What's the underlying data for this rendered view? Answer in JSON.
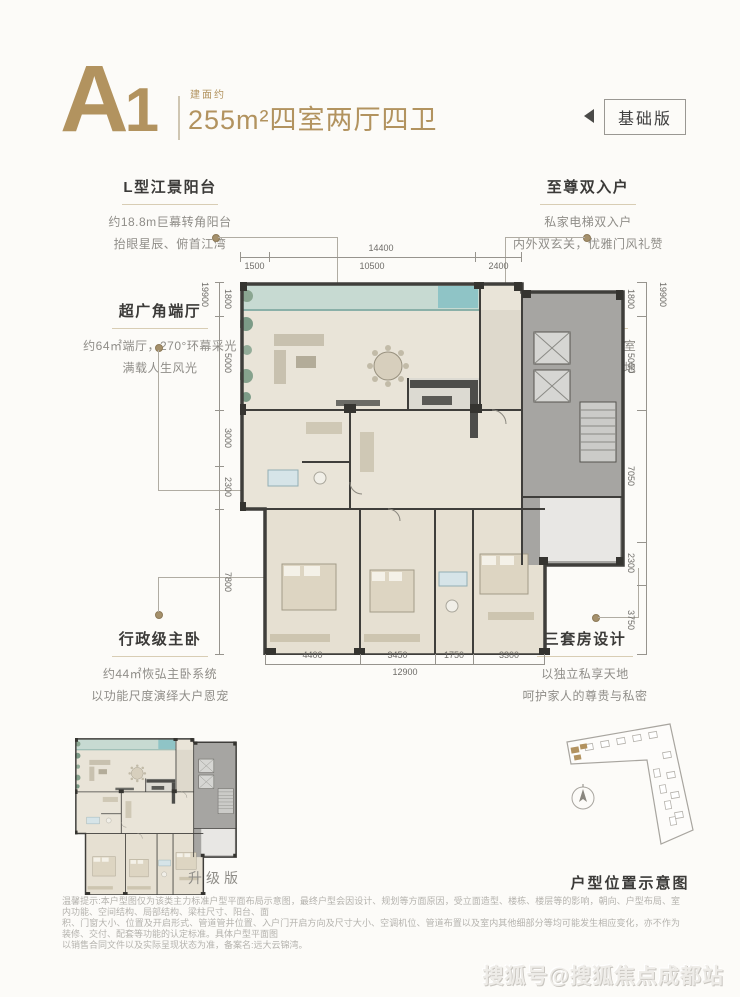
{
  "page": {
    "background": "#fcfbf8",
    "accent_gold": "#b2935f",
    "wall_dark": "#3f3e3b",
    "text_grey": "#8f8d88"
  },
  "header": {
    "plan_code_letter": "A",
    "plan_code_number": "1",
    "area_prefix": "建面约",
    "area_text": "255m²四室两厅四卫",
    "badge_label": "基础版"
  },
  "callouts": {
    "top_left": {
      "title": "L型江景阳台",
      "line1": "约18.8m巨幕转角阳台",
      "line2": "抬眼星辰、俯首江湾"
    },
    "top_right": {
      "title": "至尊双入户",
      "line1": "私家电梯双入户",
      "line2": "内外双玄关，优雅门风礼赞"
    },
    "mid_left": {
      "title": "超广角端厅",
      "line1": "约64㎡端厅，270°环幕采光",
      "line2": "满载人生风光"
    },
    "mid_right": {
      "title": "X幻变空间",
      "line1": "书房、茶室、娱乐室",
      "line2": "留一方纯粹自我天地"
    },
    "bottom_left": {
      "title": "行政级主卧",
      "line1": "约44㎡恢弘主卧系统",
      "line2": "以功能尺度演绎大户恩宠"
    },
    "bottom_right": {
      "title": "三套房设计",
      "line1": "以独立私享天地",
      "line2": "呵护家人的尊贵与私密"
    }
  },
  "dimensions": {
    "top_total": "14400",
    "top_segments": [
      "1500",
      "10500",
      "2400"
    ],
    "left_total": "19900",
    "left_segments": [
      "1800",
      "5000",
      "3000",
      "2300",
      "7800"
    ],
    "right_total": "19900",
    "right_segments": [
      "1800",
      "5000",
      "7050",
      "2300",
      "3750"
    ],
    "bottom_total": "12900",
    "bottom_segments": [
      "4400",
      "3450",
      "1750",
      "3300"
    ]
  },
  "mini_plan": {
    "label": "升级版"
  },
  "site_diagram": {
    "label": "户型位置示意图"
  },
  "disclaimer": {
    "line1": "温馨提示:本户型图仅为该类主力标准户型平面布局示意图，最终户型会因设计、规划等方面原因，受立面造型、楼栋、楼层等的影响，朝向、户型布局、室内功能、空间结构、局部结构、梁柱尺寸、阳台、面",
    "line2": "积、门窗大小、位置及开启形式、管道管井位置、入户门开启方向及尺寸大小、空调机位、管道布置以及室内其他细部分等均可能发生相应变化，亦不作为装修、交付、配套等功能的认定标准。具体户型平面图",
    "line3": "以销售合同文件以及实际呈现状态为准，备案名:远大云锦湾。"
  },
  "watermark": "搜狐号@搜狐焦点成都站"
}
